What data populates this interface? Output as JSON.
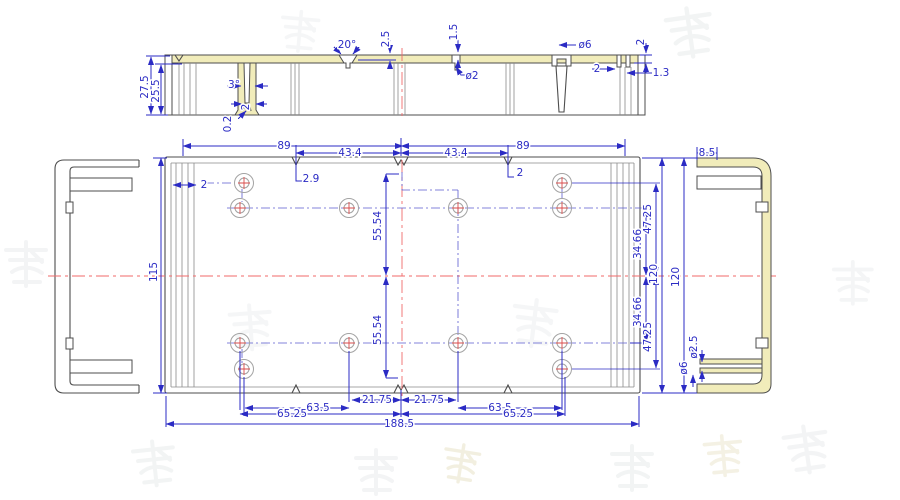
{
  "drawing": {
    "description": "CAD dimensioned drawing of an extruded aluminium enclosure: top section view, plan view with mounting holes, left and right end-profile views, faint watermark characters in background",
    "colors": {
      "dimension": "#2b2bc4",
      "outline": "#4d4d4d",
      "highlight_yellow": "#f1ecba",
      "centerline_red": "#f06a6a",
      "hole_gray": "#a3a3a3",
      "hole_cross_red": "#d94b4b",
      "watermark_gray": "#9aa7ad",
      "watermark_yellow": "#cfc48f"
    },
    "dimensions": {
      "section_view": [
        {
          "t": "27.5",
          "x": 148,
          "y": 87,
          "r": -90
        },
        {
          "t": "25.5",
          "x": 159,
          "y": 91,
          "r": -90
        },
        {
          "t": "3°",
          "x": 234,
          "y": 88
        },
        {
          "t": "2",
          "x": 249,
          "y": 107,
          "r": -90
        },
        {
          "t": "0.2",
          "x": 231,
          "y": 124,
          "r": -90
        },
        {
          "t": "20°",
          "x": 347,
          "y": 48
        },
        {
          "t": "2.5",
          "x": 389,
          "y": 39,
          "r": -90
        },
        {
          "t": "1.5",
          "x": 457,
          "y": 32,
          "r": -90
        },
        {
          "t": "ø2",
          "x": 472,
          "y": 79
        },
        {
          "t": "ø6",
          "x": 585,
          "y": 48
        },
        {
          "t": "2",
          "x": 644,
          "y": 42,
          "r": -90
        },
        {
          "t": "2",
          "x": 597,
          "y": 72
        },
        {
          "t": "1.3",
          "x": 661,
          "y": 76
        }
      ],
      "plan_view": [
        {
          "t": "89",
          "x": 284,
          "y": 149
        },
        {
          "t": "43.4",
          "x": 350,
          "y": 156
        },
        {
          "t": "43.4",
          "x": 456,
          "y": 156
        },
        {
          "t": "89",
          "x": 523,
          "y": 149
        },
        {
          "t": "2.9",
          "x": 311,
          "y": 182
        },
        {
          "t": "2",
          "x": 520,
          "y": 176
        },
        {
          "t": "2",
          "x": 204,
          "y": 188
        },
        {
          "t": "115",
          "x": 157,
          "y": 272,
          "r": -90
        },
        {
          "t": "55.54",
          "x": 381,
          "y": 226,
          "r": -90
        },
        {
          "t": "55.54",
          "x": 381,
          "y": 330,
          "r": -90
        },
        {
          "t": "34.66",
          "x": 641,
          "y": 244,
          "r": -90
        },
        {
          "t": "34.66",
          "x": 641,
          "y": 312,
          "r": -90
        },
        {
          "t": "47.25",
          "x": 651,
          "y": 219,
          "r": -90
        },
        {
          "t": "47.25",
          "x": 651,
          "y": 337,
          "r": -90
        },
        {
          "t": "120",
          "x": 657,
          "y": 274,
          "r": -90
        },
        {
          "t": "120",
          "x": 679,
          "y": 277,
          "r": -90
        },
        {
          "t": "21.75",
          "x": 377,
          "y": 403
        },
        {
          "t": "21.75",
          "x": 429,
          "y": 403
        },
        {
          "t": "63.5",
          "x": 318,
          "y": 411
        },
        {
          "t": "63.5",
          "x": 500,
          "y": 411
        },
        {
          "t": "65.25",
          "x": 292,
          "y": 417
        },
        {
          "t": "65.25",
          "x": 518,
          "y": 417
        },
        {
          "t": "188.5",
          "x": 399,
          "y": 427
        }
      ],
      "right_profile_view": [
        {
          "t": "8.5",
          "x": 707,
          "y": 156
        },
        {
          "t": "ø2.5",
          "x": 697,
          "y": 347,
          "r": -90
        },
        {
          "t": "ø6",
          "x": 687,
          "y": 368,
          "r": -90
        }
      ]
    },
    "holes": {
      "count": 12,
      "outer_radius": 9.5,
      "inner_radius": 5,
      "positions": [
        [
          244,
          183
        ],
        [
          562,
          183
        ],
        [
          240,
          208
        ],
        [
          349,
          208
        ],
        [
          458,
          208
        ],
        [
          562,
          208
        ],
        [
          240,
          343
        ],
        [
          349,
          343
        ],
        [
          458,
          343
        ],
        [
          562,
          343
        ],
        [
          244,
          369
        ],
        [
          562,
          369
        ]
      ]
    },
    "watermark": {
      "style": "faint Chinese-character watermark",
      "marks": [
        {
          "x": 660,
          "y": 10,
          "s": 1.1,
          "r": -8,
          "c": "#9aa7ad",
          "o": 0.13
        },
        {
          "x": 280,
          "y": 8,
          "s": 0.9,
          "r": 5,
          "c": "#9aa7ad",
          "o": 0.1
        },
        {
          "x": 2,
          "y": 240,
          "s": 1.0,
          "r": 0,
          "c": "#9aa7ad",
          "o": 0.12
        },
        {
          "x": 225,
          "y": 305,
          "s": 1.0,
          "r": -4,
          "c": "#9aa7ad",
          "o": 0.1
        },
        {
          "x": 512,
          "y": 295,
          "s": 1.05,
          "r": 7,
          "c": "#9aa7ad",
          "o": 0.1
        },
        {
          "x": 830,
          "y": 260,
          "s": 0.95,
          "r": 0,
          "c": "#9aa7ad",
          "o": 0.11
        },
        {
          "x": 128,
          "y": 442,
          "s": 1.0,
          "r": -6,
          "c": "#9aa7ad",
          "o": 0.13
        },
        {
          "x": 352,
          "y": 448,
          "s": 1.0,
          "r": 0,
          "c": "#9aa7ad",
          "o": 0.12
        },
        {
          "x": 444,
          "y": 440,
          "s": 0.85,
          "r": 9,
          "c": "#cfc48f",
          "o": 0.28
        },
        {
          "x": 608,
          "y": 444,
          "s": 1.0,
          "r": 0,
          "c": "#9aa7ad",
          "o": 0.13
        },
        {
          "x": 700,
          "y": 436,
          "s": 0.9,
          "r": -5,
          "c": "#cfc48f",
          "o": 0.24
        },
        {
          "x": 778,
          "y": 428,
          "s": 1.05,
          "r": -8,
          "c": "#9aa7ad",
          "o": 0.12
        }
      ]
    }
  }
}
